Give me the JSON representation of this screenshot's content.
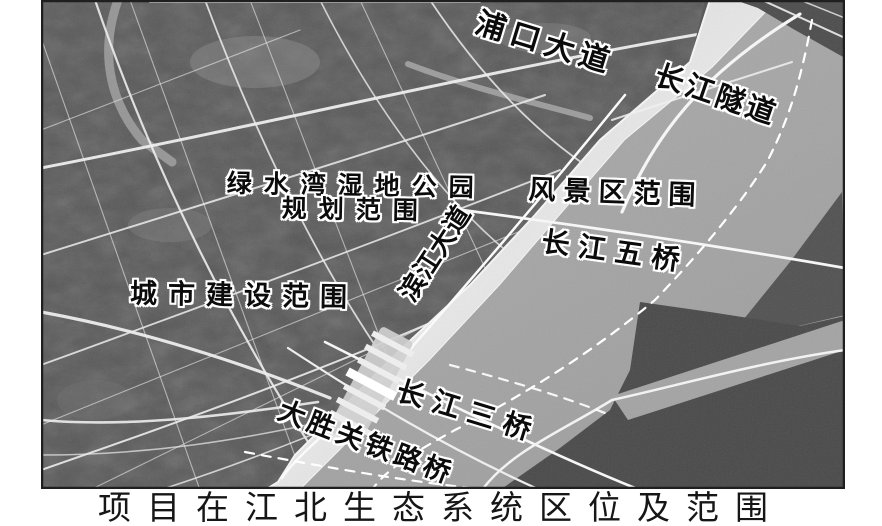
{
  "figure": {
    "type": "grayscale satellite location map",
    "caption": "项目在江北生态系统区位及范围"
  },
  "map": {
    "labels": [
      {
        "id": "pukou-avenue",
        "text": "浦口大道"
      },
      {
        "id": "changjiang-tunnel",
        "text": "长江隧道"
      },
      {
        "id": "lvshuiwan-wetland-park-scope",
        "text": "绿水湾湿地公园",
        "text2": "规划范围"
      },
      {
        "id": "scenic-area-scope",
        "text": "风景区范围"
      },
      {
        "id": "binjiang-avenue",
        "text": "滨江大道"
      },
      {
        "id": "changjiang-fifth-bridge",
        "text": "长江五桥"
      },
      {
        "id": "urban-construction-scope",
        "text": "城市建设范围"
      },
      {
        "id": "changjiang-third-bridge",
        "text": "长江三桥"
      },
      {
        "id": "dashengguan-railway-bridge",
        "text": "大胜关铁路桥"
      }
    ],
    "colors": {
      "river": "#a8a8a8",
      "land": "#565656",
      "wetland": "#dedede",
      "road": "#f2f2f2",
      "label_text": "#0b0b0b",
      "label_halo": "#ffffff",
      "border": "#1f1f1f",
      "background": "#ffffff"
    }
  }
}
